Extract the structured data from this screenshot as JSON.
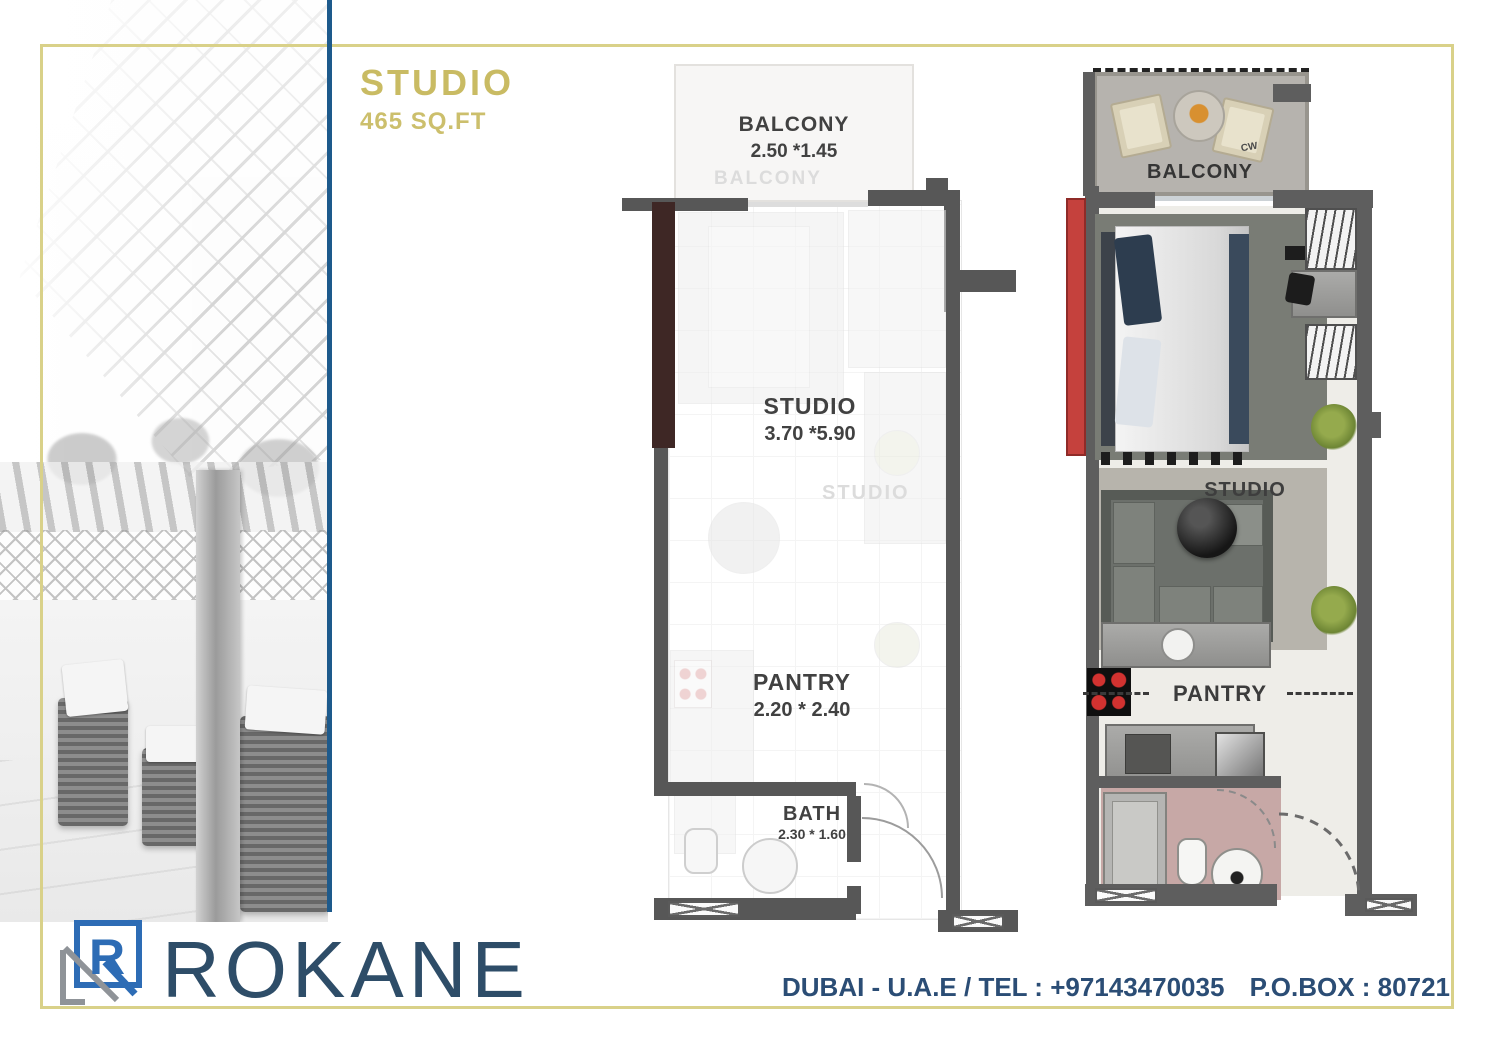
{
  "colors": {
    "frame_gold": "#d9d189",
    "divider_blue": "#1d5a8c",
    "title_gold": "#c9bb63",
    "brand_navy": "#2e4d68",
    "footer_blue": "#2b4d75",
    "wall_gray": "#575757",
    "accent_red": "#c5413d",
    "accent_maroon": "#3e2725",
    "bath_pink": "#c7a8a6"
  },
  "title": {
    "name": "STUDIO",
    "area": "465 SQ.FT"
  },
  "plan_bw": {
    "balcony_label": "BALCONY",
    "balcony_dims": "2.50  *1.45",
    "balcony_ghost": "BALCONY",
    "studio_label": "STUDIO",
    "studio_dims": "3.70  *5.90",
    "studio_ghost": "STUDIO",
    "pantry_label": "PANTRY",
    "pantry_dims": "2.20 * 2.40",
    "bath_label": "BATH",
    "bath_dims": "2.30 * 1.60"
  },
  "plan_color": {
    "balcony_label": "BALCONY",
    "cw_label": "CW",
    "studio_label": "STUDIO",
    "pantry_label": "PANTRY"
  },
  "footer": {
    "logo_letter": "R",
    "brand": "ROKANE",
    "contact": "DUBAI - U.A.E / TEL : +97143470035",
    "pobox": "P.O.BOX : 80721"
  }
}
